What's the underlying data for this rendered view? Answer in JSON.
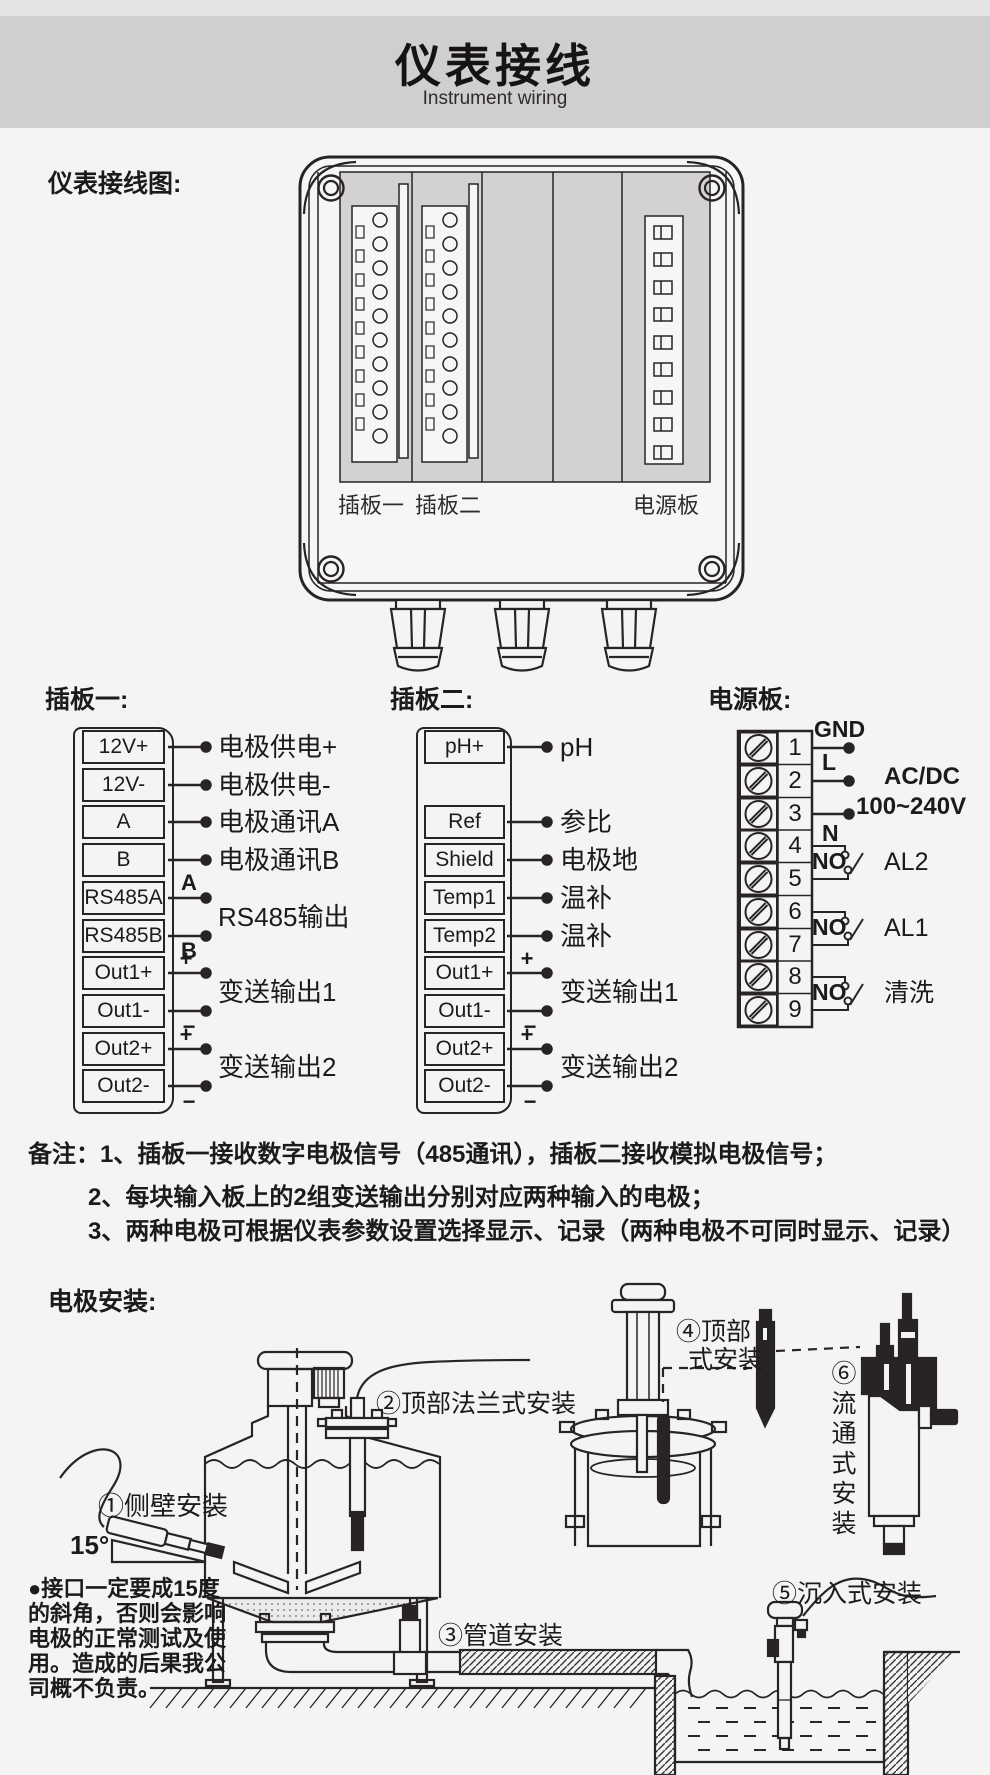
{
  "colors": {
    "line": "#282425",
    "panel": "#d3d1d1",
    "band": "#d0cecf",
    "background": "#f5f4f4"
  },
  "header": {
    "title": "仪表接线",
    "subtitle": "Instrument wiring"
  },
  "wiring": {
    "heading": "仪表接线图:",
    "enclosure_labels": {
      "slot1": "插板一",
      "slot2": "插板二",
      "power": "电源板"
    }
  },
  "board1": {
    "heading": "插板一:",
    "terminals": [
      "12V+",
      "12V-",
      "A",
      "B",
      "RS485A",
      "RS485B",
      "Out1+",
      "Out1-",
      "Out2+",
      "Out2-"
    ],
    "wire_labels": [
      "电极供电+",
      "电极供电-",
      "电极通讯A",
      "电极通讯B"
    ],
    "rs485": {
      "tag_a": "A",
      "tag_b": "B",
      "label": "RS485输出"
    },
    "out1": {
      "tag_plus": "+",
      "tag_minus": "−",
      "label": "变送输出1"
    },
    "out2": {
      "tag_plus": "+",
      "tag_minus": "−",
      "label": "变送输出2"
    }
  },
  "board2": {
    "heading": "插板二:",
    "terminals": [
      "pH+",
      "Ref",
      "Shield",
      "Temp1",
      "Temp2",
      "Out1+",
      "Out1-",
      "Out2+",
      "Out2-"
    ],
    "wire_labels": [
      "pH",
      "参比",
      "电极地",
      "温补",
      "温补"
    ],
    "out1": {
      "tag_plus": "+",
      "tag_minus": "−",
      "label": "变送输出1"
    },
    "out2": {
      "tag_plus": "+",
      "tag_minus": "−",
      "label": "变送输出2"
    }
  },
  "power": {
    "heading": "电源板:",
    "terminals": [
      "1",
      "2",
      "3",
      "4",
      "5",
      "6",
      "7",
      "8",
      "9"
    ],
    "gnd": "GND",
    "line": "L",
    "neutral": "N",
    "supply_line1": "AC/DC",
    "supply_line2": "100~240V",
    "relays": [
      {
        "no": "NO",
        "label": "AL2"
      },
      {
        "no": "NO",
        "label": "AL1"
      },
      {
        "no": "NO",
        "label": "清洗"
      }
    ]
  },
  "notes": {
    "line1": "备注：1、插板一接收数字电极信号（485通讯），插板二接收模拟电极信号；",
    "line2": "2、每块输入板上的2组变送输出分别对应两种输入的电极；",
    "line3": "3、两种电极可根据仪表参数设置选择显示、记录（两种电极不可同时显示、记录）"
  },
  "install": {
    "heading": "电极安装:",
    "method1": "①侧壁安装",
    "method2": "②顶部法兰式安装",
    "method3": "③管道安装",
    "method4_line1": "④顶部",
    "method4_line2": "式安装",
    "method5": "⑤沉入式安装",
    "method6": "⑥流通式安装",
    "angle": "15°",
    "warning": [
      "●接口一定要成15度",
      "的斜角，否则会影响",
      "电极的正常测试及使",
      "用。造成的后果我公",
      "司概不负责。"
    ]
  }
}
